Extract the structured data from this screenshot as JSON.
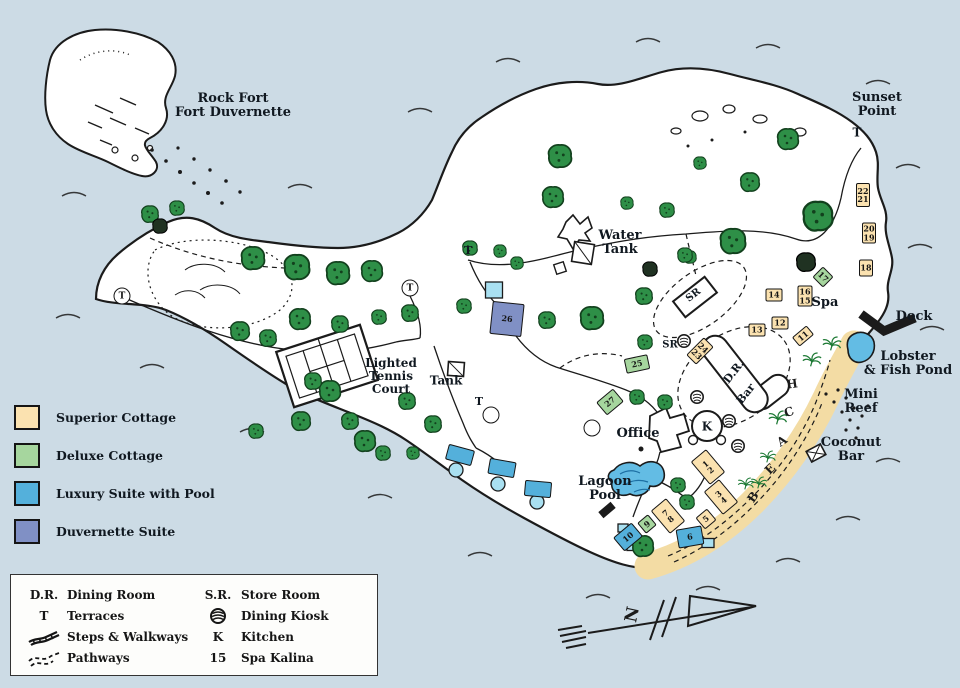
{
  "colors": {
    "ocean": "#ccdbe5",
    "land": "#ffffff",
    "ink": "#1b1b1b",
    "sand": "#f3dca4",
    "superior": "#fbe2b0",
    "deluxe": "#a6d69e",
    "luxury": "#54b0db",
    "duvernette": "#8090c5",
    "pool": "#a9e0f1",
    "water_feature": "#63bce4",
    "tree": "#2e8f47",
    "tree_dark": "#203222",
    "label": "#101820"
  },
  "legend_cottages": [
    {
      "label": "Superior Cottage",
      "type": "superior"
    },
    {
      "label": "Deluxe Cottage",
      "type": "deluxe"
    },
    {
      "label": "Luxury Suite with Pool",
      "type": "luxury"
    },
    {
      "label": "Duvernette Suite",
      "type": "duvernette"
    }
  ],
  "legend_bottom": {
    "col1": [
      {
        "sym": "D.R.",
        "label": "Dining Room"
      },
      {
        "sym": "T",
        "label": "Terraces"
      },
      {
        "sym": "",
        "label": "Steps & Walkways"
      },
      {
        "sym": "",
        "label": "Pathways"
      }
    ],
    "col2": [
      {
        "sym": "S.R.",
        "label": "Store Room"
      },
      {
        "sym": "",
        "label": "Dining Kiosk"
      },
      {
        "sym": "K",
        "label": "Kitchen"
      },
      {
        "sym": "15",
        "label": "Spa Kalina"
      }
    ]
  },
  "compass": {
    "label": "N"
  },
  "map": {
    "labels": [
      {
        "id": "rock-fort",
        "lines": [
          "Rock Fort",
          "Fort Duvernette"
        ],
        "x": 233,
        "y": 106,
        "s": 13
      },
      {
        "id": "sunset-point",
        "lines": [
          "Sunset",
          "Point"
        ],
        "x": 877,
        "y": 105,
        "s": 13
      },
      {
        "id": "sunset-terrace",
        "lines": [
          "T"
        ],
        "x": 857,
        "y": 133,
        "s": 12
      },
      {
        "id": "water-tank",
        "lines": [
          "Water",
          "Tank"
        ],
        "x": 620,
        "y": 243,
        "s": 13
      },
      {
        "id": "tank",
        "lines": [
          "Tank"
        ],
        "x": 446,
        "y": 381,
        "s": 12
      },
      {
        "id": "tennis-court",
        "lines": [
          "Lighted",
          "Tennis",
          "Court"
        ],
        "x": 391,
        "y": 376,
        "s": 12
      },
      {
        "id": "spa",
        "lines": [
          "Spa"
        ],
        "x": 825,
        "y": 303,
        "s": 13
      },
      {
        "id": "dock",
        "lines": [
          "Dock"
        ],
        "x": 914,
        "y": 317,
        "s": 13
      },
      {
        "id": "lobster-fish-pond",
        "lines": [
          "Lobster",
          "& Fish Pond"
        ],
        "x": 908,
        "y": 364,
        "s": 13
      },
      {
        "id": "mini-reef",
        "lines": [
          "Mini",
          "Reef"
        ],
        "x": 861,
        "y": 402,
        "s": 13
      },
      {
        "id": "coconut-bar",
        "lines": [
          "Coconut",
          "Bar"
        ],
        "x": 851,
        "y": 450,
        "s": 13
      },
      {
        "id": "office",
        "lines": [
          "Office"
        ],
        "x": 638,
        "y": 434,
        "s": 13
      },
      {
        "id": "lagoon-pool",
        "lines": [
          "Lagoon",
          "Pool"
        ],
        "x": 605,
        "y": 489,
        "s": 13
      },
      {
        "id": "dining-room",
        "lines": [
          "D.R."
        ],
        "x": 734,
        "y": 372,
        "s": 11,
        "r": -52
      },
      {
        "id": "bar",
        "lines": [
          "Bar"
        ],
        "x": 746,
        "y": 394,
        "s": 11,
        "r": -52
      },
      {
        "id": "store-room-building",
        "lines": [
          "SR"
        ],
        "x": 694,
        "y": 296,
        "s": 10,
        "r": -38
      },
      {
        "id": "store-room",
        "lines": [
          "SR"
        ],
        "x": 670,
        "y": 346,
        "s": 10
      },
      {
        "id": "kitchen",
        "lines": [
          "K"
        ],
        "x": 707,
        "y": 427,
        "s": 12
      },
      {
        "id": "terrace-north",
        "lines": [
          "T"
        ],
        "x": 468,
        "y": 251,
        "s": 11
      },
      {
        "id": "terrace-mid",
        "lines": [
          "T"
        ],
        "x": 479,
        "y": 402,
        "s": 11
      }
    ],
    "cottages": [
      {
        "n": [
          "1",
          "2"
        ],
        "t": "superior",
        "x": 708,
        "y": 467,
        "w": 20,
        "h": 30,
        "r": -40
      },
      {
        "n": [
          "3",
          "4"
        ],
        "t": "superior",
        "x": 721,
        "y": 497,
        "w": 20,
        "h": 30,
        "r": -40
      },
      {
        "n": [
          "5"
        ],
        "t": "superior",
        "x": 706,
        "y": 519,
        "w": 15,
        "h": 15,
        "r": -40
      },
      {
        "n": [
          "6"
        ],
        "t": "luxury",
        "x": 690,
        "y": 537,
        "w": 26,
        "h": 19,
        "r": -10
      },
      {
        "n": [
          "7",
          "8"
        ],
        "t": "superior",
        "x": 668,
        "y": 516,
        "w": 20,
        "h": 30,
        "r": -40
      },
      {
        "n": [
          "9"
        ],
        "t": "deluxe",
        "x": 647,
        "y": 524,
        "w": 14,
        "h": 14,
        "r": -40
      },
      {
        "n": [
          "10"
        ],
        "t": "luxury",
        "x": 628,
        "y": 537,
        "w": 24,
        "h": 18,
        "r": -40
      },
      {
        "n": [
          "11"
        ],
        "t": "superior",
        "x": 803,
        "y": 336,
        "w": 19,
        "h": 12,
        "r": -40
      },
      {
        "n": [
          "12"
        ],
        "t": "superior",
        "x": 780,
        "y": 323,
        "w": 17,
        "h": 13,
        "r": 0
      },
      {
        "n": [
          "13"
        ],
        "t": "superior",
        "x": 757,
        "y": 330,
        "w": 17,
        "h": 13,
        "r": 0
      },
      {
        "n": [
          "14"
        ],
        "t": "superior",
        "x": 774,
        "y": 295,
        "w": 17,
        "h": 13,
        "r": 0
      },
      {
        "n": [
          "16",
          "15"
        ],
        "t": "superior",
        "x": 805,
        "y": 296,
        "w": 15,
        "h": 21,
        "r": 0
      },
      {
        "n": [
          "17"
        ],
        "t": "deluxe",
        "x": 823,
        "y": 277,
        "w": 15,
        "h": 15,
        "r": 45
      },
      {
        "n": [
          "18"
        ],
        "t": "superior",
        "x": 866,
        "y": 268,
        "w": 14,
        "h": 17,
        "r": 0
      },
      {
        "n": [
          "20",
          "19"
        ],
        "t": "superior",
        "x": 869,
        "y": 233,
        "w": 14,
        "h": 21,
        "r": 0
      },
      {
        "n": [
          "22",
          "21"
        ],
        "t": "superior",
        "x": 863,
        "y": 195,
        "w": 14,
        "h": 24,
        "r": 0
      },
      {
        "n": [
          "24",
          "23"
        ],
        "t": "superior",
        "x": 700,
        "y": 351,
        "w": 14,
        "h": 25,
        "r": 45
      },
      {
        "n": [
          "25"
        ],
        "t": "deluxe",
        "x": 637,
        "y": 364,
        "w": 24,
        "h": 15,
        "r": -12
      },
      {
        "n": [
          "26"
        ],
        "t": "duvernette",
        "x": 507,
        "y": 319,
        "w": 32,
        "h": 33,
        "r": 6
      },
      {
        "n": [
          "27"
        ],
        "t": "deluxe",
        "x": 610,
        "y": 402,
        "w": 22,
        "h": 17,
        "r": -40
      },
      {
        "n": [],
        "t": "luxury",
        "x": 460,
        "y": 455,
        "w": 27,
        "h": 16,
        "r": 15
      },
      {
        "n": [],
        "t": "luxury",
        "x": 502,
        "y": 468,
        "w": 27,
        "h": 16,
        "r": 10
      },
      {
        "n": [],
        "t": "luxury",
        "x": 538,
        "y": 489,
        "w": 27,
        "h": 16,
        "r": 5
      }
    ],
    "terraces": [
      {
        "x": 122,
        "y": 296,
        "t": "T"
      },
      {
        "x": 410,
        "y": 288,
        "t": "T"
      },
      {
        "x": 491,
        "y": 415,
        "t": ""
      },
      {
        "x": 592,
        "y": 428,
        "t": ""
      }
    ],
    "beach_word": [
      {
        "c": "B",
        "x": 753,
        "y": 497,
        "r": -55
      },
      {
        "c": "E",
        "x": 770,
        "y": 469,
        "r": -45
      },
      {
        "c": "A",
        "x": 782,
        "y": 441,
        "r": -35
      },
      {
        "c": "C",
        "x": 789,
        "y": 412,
        "r": -20
      },
      {
        "c": "H",
        "x": 792,
        "y": 384,
        "r": -8
      }
    ],
    "trees": {
      "g": [
        [
          150,
          214,
          8
        ],
        [
          177,
          208,
          7
        ],
        [
          253,
          258,
          11
        ],
        [
          297,
          267,
          12
        ],
        [
          338,
          273,
          11
        ],
        [
          372,
          271,
          10
        ],
        [
          300,
          319,
          10
        ],
        [
          240,
          331,
          9
        ],
        [
          268,
          338,
          8
        ],
        [
          330,
          391,
          10
        ],
        [
          301,
          421,
          9
        ],
        [
          256,
          431,
          7
        ],
        [
          365,
          441,
          10
        ],
        [
          340,
          324,
          8
        ],
        [
          379,
          317,
          7
        ],
        [
          410,
          313,
          8
        ],
        [
          313,
          381,
          8
        ],
        [
          350,
          421,
          8
        ],
        [
          407,
          401,
          8
        ],
        [
          433,
          424,
          8
        ],
        [
          383,
          453,
          7
        ],
        [
          413,
          453,
          6
        ],
        [
          560,
          156,
          11
        ],
        [
          553,
          197,
          10
        ],
        [
          470,
          248,
          7
        ],
        [
          500,
          251,
          6
        ],
        [
          517,
          263,
          6
        ],
        [
          627,
          203,
          6
        ],
        [
          667,
          210,
          7
        ],
        [
          690,
          257,
          6
        ],
        [
          788,
          139,
          10
        ],
        [
          750,
          182,
          9
        ],
        [
          700,
          163,
          6
        ],
        [
          733,
          241,
          12
        ],
        [
          818,
          216,
          14
        ],
        [
          685,
          255,
          7
        ],
        [
          644,
          296,
          8
        ],
        [
          592,
          318,
          11
        ],
        [
          645,
          342,
          7
        ],
        [
          547,
          320,
          8
        ],
        [
          464,
          306,
          7
        ],
        [
          678,
          485,
          7
        ],
        [
          687,
          502,
          7
        ],
        [
          643,
          546,
          10
        ],
        [
          637,
          397,
          7
        ],
        [
          665,
          402,
          7
        ]
      ],
      "d": [
        [
          160,
          226,
          7
        ],
        [
          806,
          262,
          9
        ],
        [
          650,
          269,
          7
        ]
      ],
      "p": [
        [
          832,
          344,
          7
        ],
        [
          812,
          360,
          7
        ],
        [
          778,
          418,
          7
        ],
        [
          768,
          457,
          6
        ],
        [
          759,
          483,
          6
        ],
        [
          746,
          484,
          6
        ]
      ]
    },
    "pools": [
      {
        "x": 494,
        "y": 290,
        "w": 17,
        "h": 16
      },
      {
        "x": 456,
        "y": 470,
        "cr": 7
      },
      {
        "x": 498,
        "y": 484,
        "cr": 7
      },
      {
        "x": 537,
        "y": 502,
        "cr": 7
      },
      {
        "x": 623,
        "y": 528,
        "w": 10,
        "h": 8
      },
      {
        "x": 633,
        "y": 546,
        "w": 12,
        "h": 9
      },
      {
        "x": 708,
        "y": 543,
        "w": 12,
        "h": 9
      }
    ],
    "kiosks": [
      [
        697,
        397
      ],
      [
        729,
        421
      ],
      [
        738,
        446
      ],
      [
        684,
        341
      ]
    ]
  }
}
